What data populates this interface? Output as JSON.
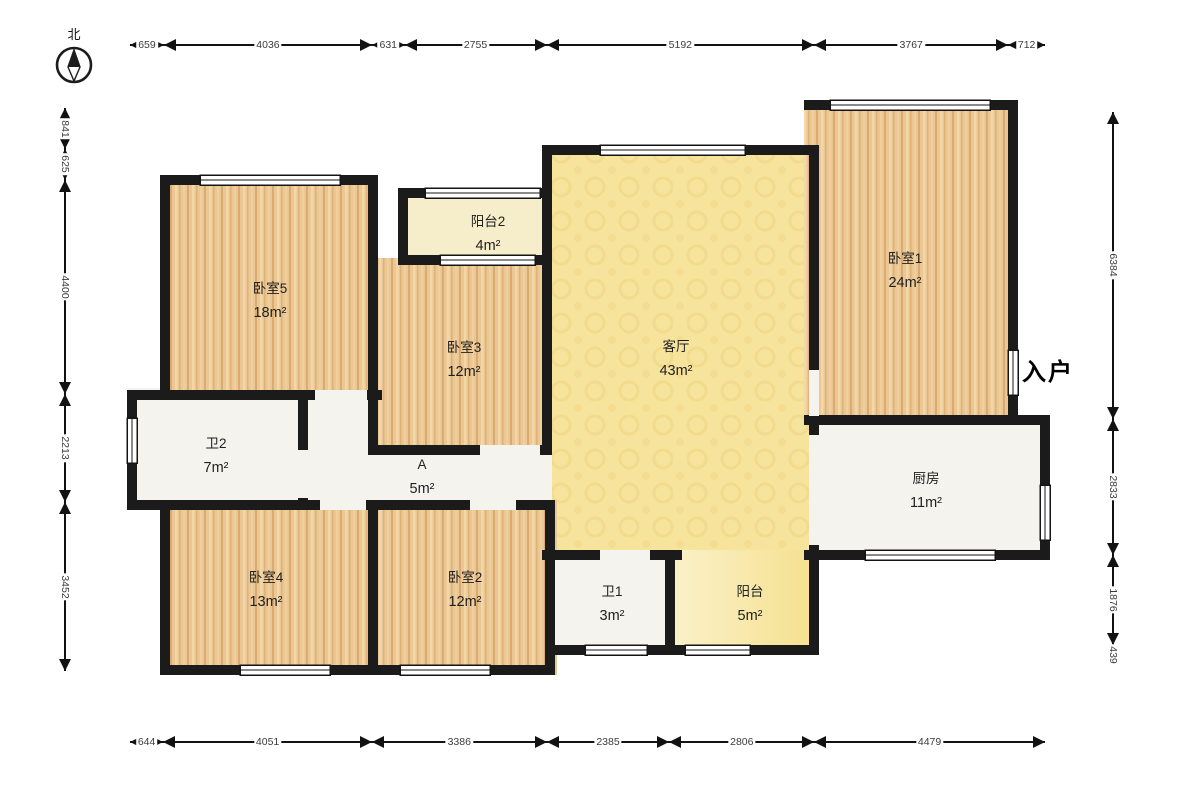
{
  "compass": {
    "label": "北"
  },
  "entry_label": "入户",
  "rooms": [
    {
      "id": "bedroom5",
      "name": "卧室5",
      "area": "18m²"
    },
    {
      "id": "balcony2",
      "name": "阳台2",
      "area": "4m²"
    },
    {
      "id": "bedroom3",
      "name": "卧室3",
      "area": "12m²"
    },
    {
      "id": "living-room",
      "name": "客厅",
      "area": "43m²"
    },
    {
      "id": "bedroom1",
      "name": "卧室1",
      "area": "24m²"
    },
    {
      "id": "bathroom2",
      "name": "卫2",
      "area": "7m²"
    },
    {
      "id": "hall-a",
      "name": "A",
      "area": "5m²"
    },
    {
      "id": "kitchen",
      "name": "厨房",
      "area": "11m²"
    },
    {
      "id": "bedroom4",
      "name": "卧室4",
      "area": "13m²"
    },
    {
      "id": "bedroom2",
      "name": "卧室2",
      "area": "12m²"
    },
    {
      "id": "bathroom1",
      "name": "卫1",
      "area": "3m²"
    },
    {
      "id": "balcony",
      "name": "阳台",
      "area": "5m²"
    }
  ],
  "dimensions": {
    "top": [
      659,
      4036,
      631,
      2755,
      5192,
      3767,
      712
    ],
    "bottom": [
      644,
      4051,
      3386,
      2385,
      2806,
      4479
    ],
    "left": [
      841,
      625,
      4400,
      2213,
      3452
    ],
    "right": [
      6384,
      2833,
      1876,
      439
    ]
  },
  "colors": {
    "wall": "#1b1b1b",
    "wood_floor": "#eac795",
    "living_room_fill": "#f7e49c",
    "white_room_fill": "#f4f3ee",
    "balcony2_fill": "#f6eecb",
    "balcony_fill": "#f5e08d"
  }
}
